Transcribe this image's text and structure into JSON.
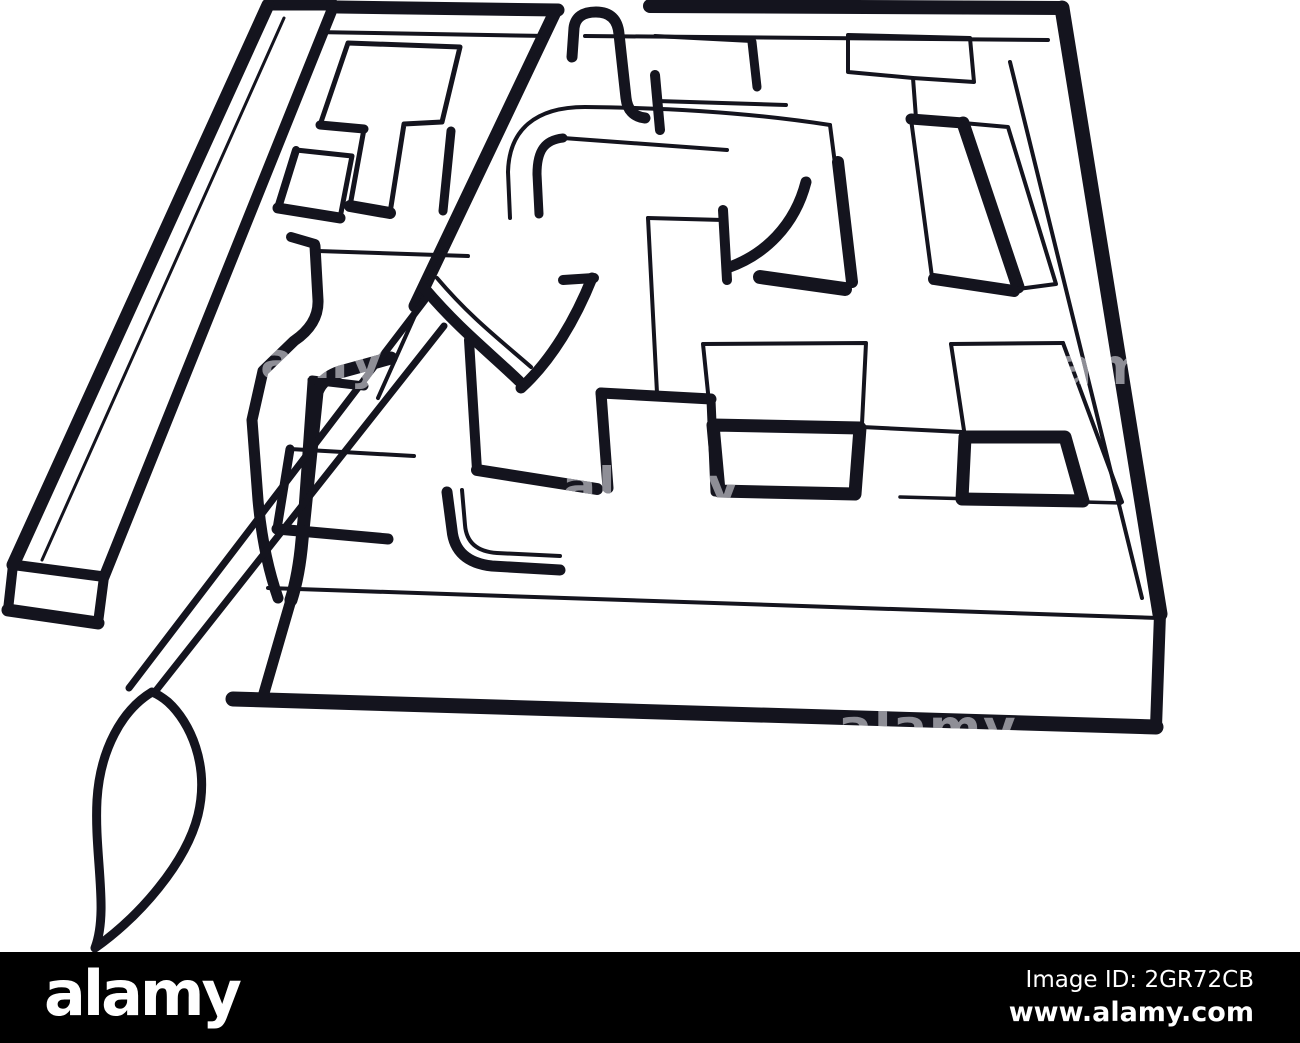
{
  "page": {
    "background_color": "#ffffff",
    "ink_color": "#14141e",
    "footer_background": "#000000"
  },
  "illustration": {
    "subject": "3d-outline-maze-with-paintbrush-pointer-escaping",
    "watermark_text": "alamy"
  },
  "footer": {
    "logo_text": "alamy",
    "image_id": "Image ID: 2GR72CB",
    "website": "www.alamy.com"
  }
}
